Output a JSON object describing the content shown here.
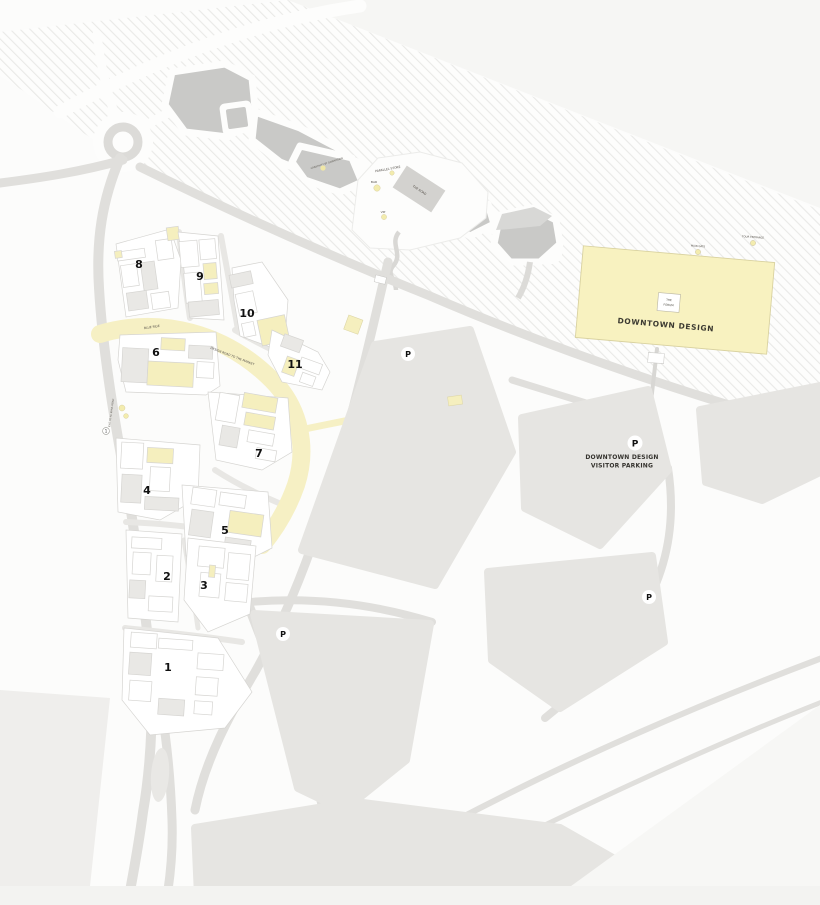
{
  "map": {
    "region_title": "DOWNTOWN DESIGN",
    "forum": {
      "line1": "THE",
      "line2": "FORUM"
    },
    "visitor_parking": {
      "line1": "DOWNTOWN DESIGN",
      "line2": "VISITOR PARKING"
    },
    "parking_symbol": "P",
    "gate_marker": "1",
    "blocks": [
      "1",
      "2",
      "3",
      "4",
      "5",
      "6",
      "7",
      "8",
      "9",
      "10",
      "11"
    ],
    "venue_labels": {
      "parallel_store": "PARALLEL STORE",
      "bar": "BAR",
      "vip": "VIP",
      "the_road": "THE ROAD",
      "park_feature": "CREATIVITY BY DOWNTOWN"
    },
    "gate_labels": {
      "main_gate": "MAIN GATE",
      "tour_entrance": "TOUR ENTRANCE"
    },
    "road_labels": {
      "blue_ride": "BLUE RIDE",
      "design_road": "DESIGN ROAD TO THE MARKET",
      "exit_road": "EXIT TO AL KHAIL ROAD"
    },
    "colors": {
      "hall_yellow": "#f8f2c0",
      "boulevard_yellow": "#f6f0c4",
      "parcel_gray": "#e6e5e2",
      "park_gray": "#c9c9c7",
      "road_gray": "#e0dfdc"
    }
  }
}
